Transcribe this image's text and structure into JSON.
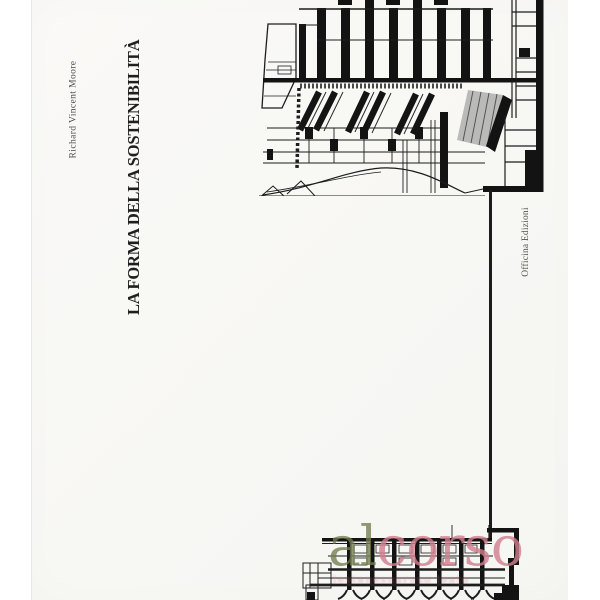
{
  "cover": {
    "author": "Richard Vincent Moore",
    "title": "LA FORMA DELLA SOSTENIBILITÀ",
    "publisher": "Officina Edizioni",
    "background_color": "#f8f8f5",
    "ink_color": "#1d1d1d"
  },
  "artwork": {
    "top_drawing_name": "architectural-section-drawing-rotated",
    "bottom_drawing_name": "architectural-section-fragment",
    "connector_line_name": "thin-vertical-rule"
  },
  "watermark": {
    "part1": "al",
    "part2": "corso",
    "part1_color": "#717f50",
    "part2_color": "#d17e8e",
    "tagline_approx": "lestanesnaruso leato"
  }
}
